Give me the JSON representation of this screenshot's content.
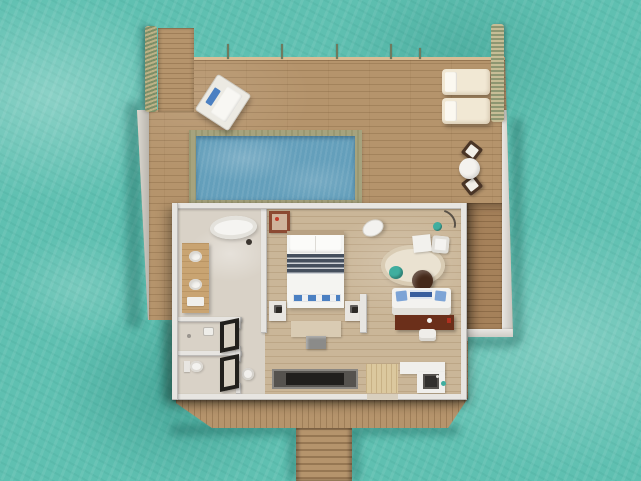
{
  "scene": {
    "type": "3d-aerial-floor-plan-render",
    "subject": "overwater-villa-with-pool",
    "environment": "turquoise-sea",
    "areas": [
      "arrival-walkway",
      "sun-deck",
      "plunge-pool",
      "bathroom",
      "shower-room",
      "toilet-room",
      "bedroom",
      "living-area",
      "kitchenette",
      "side-deck",
      "rear-deck",
      "jetty-stairs"
    ],
    "deck_objects": [
      "daybed",
      "sun-lounger",
      "sun-lounger",
      "round-dining-table",
      "wicker-chair",
      "wicker-chair",
      "rope-coil",
      "rope-garland-railing",
      "edge-posts"
    ],
    "interior_objects": [
      "bathtub",
      "double-vanity",
      "shower-head",
      "toilet",
      "glass-door",
      "glass-door",
      "pedestal-basin",
      "double-bed",
      "nightstand",
      "nightstand",
      "foot-bench",
      "tv",
      "dresser-glass-panel",
      "hanging-chair",
      "round-rug",
      "coffee-table",
      "teal-pouf",
      "writing-desk",
      "desk-chair",
      "plant",
      "floor-lamp",
      "sofa",
      "console-desk",
      "console-chair",
      "kitchen-counter",
      "kitchen-sink",
      "entry-mat",
      "wall-art"
    ]
  },
  "palette": {
    "water": "#5fc0b1",
    "water-dark": "#2f9487",
    "deck": "#b5946c",
    "deck-dark": "#a5815a",
    "pool": "#649fbb",
    "pool-coping": "#a6a37e",
    "wall": "#e7e5e1",
    "bath-floor": "#d9d2c7",
    "wood-floor": "#cab698",
    "vanity": "#c9a472",
    "console": "#6b2f1a",
    "navy": "#454f5d",
    "blue": "#4b80c2",
    "teal": "#3fae9f",
    "cream": "#f1e8d4",
    "brown-dark": "#4a3526"
  }
}
